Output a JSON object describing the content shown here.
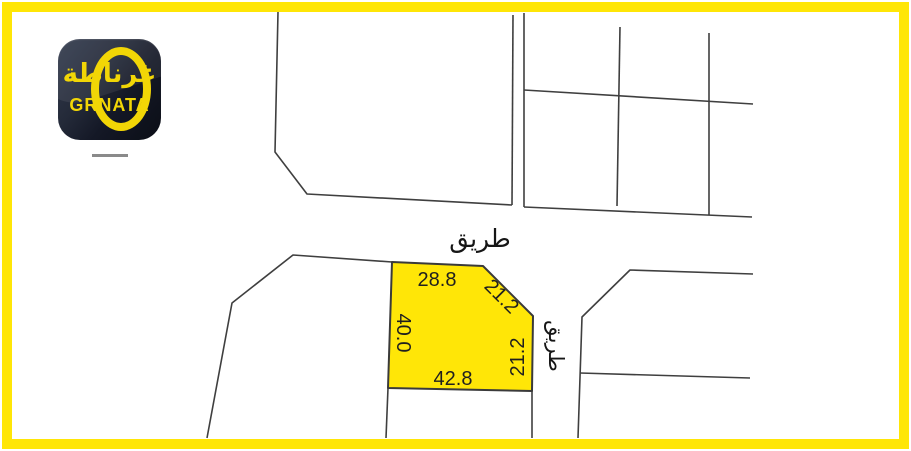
{
  "brand": {
    "logo_arabic": "غرناطة",
    "logo_latin": "GRNATA",
    "accent_yellow": "#ffe607",
    "logo_background": "#1b2030"
  },
  "map": {
    "road_label_top": "طريق",
    "road_label_right": "طريق",
    "line_color": "#3f3f3f",
    "plot": {
      "fill": "#ffe607",
      "dimensions": {
        "top": "28.8",
        "diagonal": "21.2",
        "left": "40.0",
        "right": "21.2",
        "bottom": "42.8"
      }
    }
  }
}
